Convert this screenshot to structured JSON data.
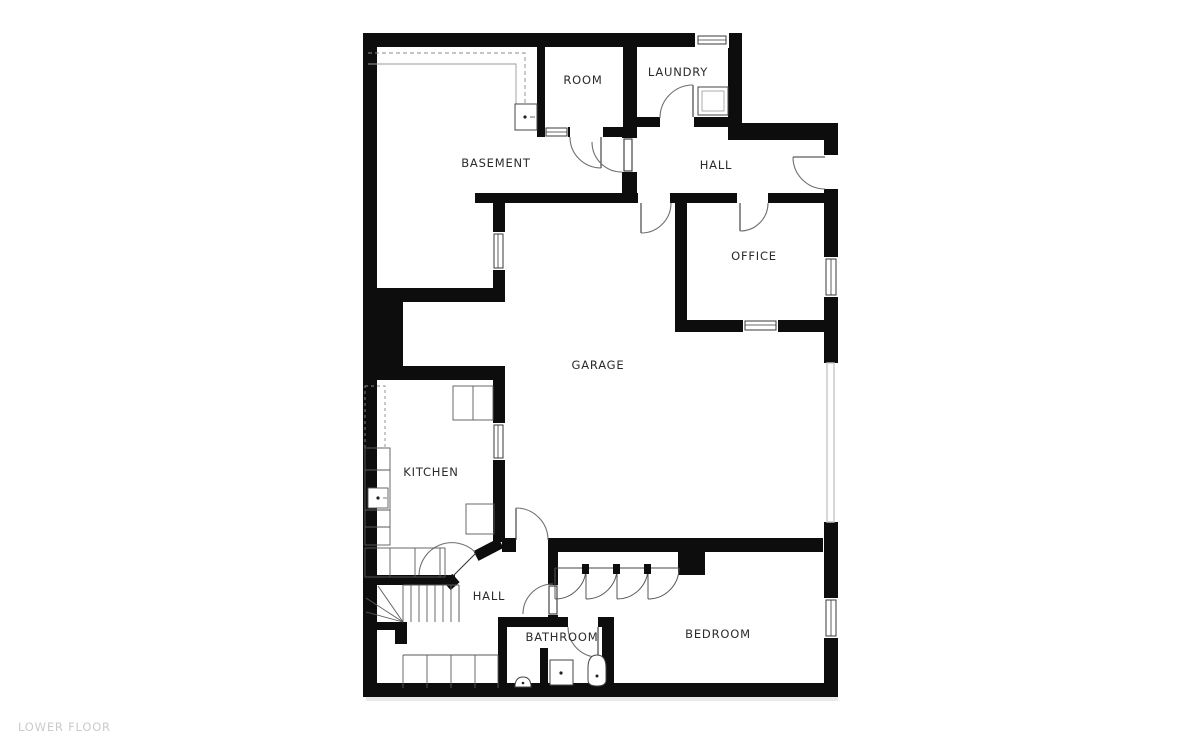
{
  "floor_plan": {
    "title": "LOWER FLOOR",
    "rooms": [
      {
        "id": "basement",
        "label": "BASEMENT"
      },
      {
        "id": "room",
        "label": "ROOM"
      },
      {
        "id": "laundry",
        "label": "LAUNDRY"
      },
      {
        "id": "hall-upper",
        "label": "HALL"
      },
      {
        "id": "office",
        "label": "OFFICE"
      },
      {
        "id": "garage",
        "label": "GARAGE"
      },
      {
        "id": "kitchen",
        "label": "KITCHEN"
      },
      {
        "id": "hall-lower",
        "label": "HALL"
      },
      {
        "id": "bathroom",
        "label": "BATHROOM"
      },
      {
        "id": "bedroom",
        "label": "BEDROOM"
      }
    ],
    "colors": {
      "wall": "#0d0d0d",
      "background": "#ffffff",
      "door_arc": "#6f6f6f",
      "thin_line": "#5a5a5a",
      "dashed_line": "#8a8a8a",
      "garage_door": "#c6c6c6",
      "label_text": "#2b2b2b",
      "title_text": "#cbcbcb",
      "shadow": "#e3e3e3"
    },
    "fixtures": [
      "water-heater",
      "kitchen-sink",
      "kitchen-island",
      "stairs",
      "bathroom-vanity",
      "toilet",
      "hand-sink",
      "closet-doors",
      "garage-door"
    ]
  }
}
